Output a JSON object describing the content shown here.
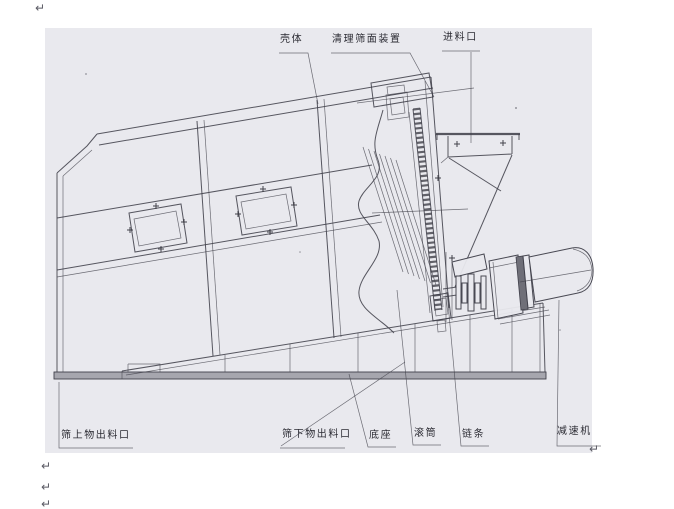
{
  "labels": {
    "shell": "壳体",
    "screen_cleaning_device": "清理筛面装置",
    "feed_inlet": "进料口",
    "oversize_outlet": "筛上物出料口",
    "undersize_outlet": "筛下物出料口",
    "base": "底座",
    "drum": "滚筒",
    "chain": "链条",
    "reducer": "减速机"
  },
  "marks": {
    "paragraph_glyph": "↵"
  },
  "colors": {
    "paper": "#ffffff",
    "scan_background": "#e9e9ee",
    "line": "#41414b",
    "label_text": "#2b2b33"
  }
}
